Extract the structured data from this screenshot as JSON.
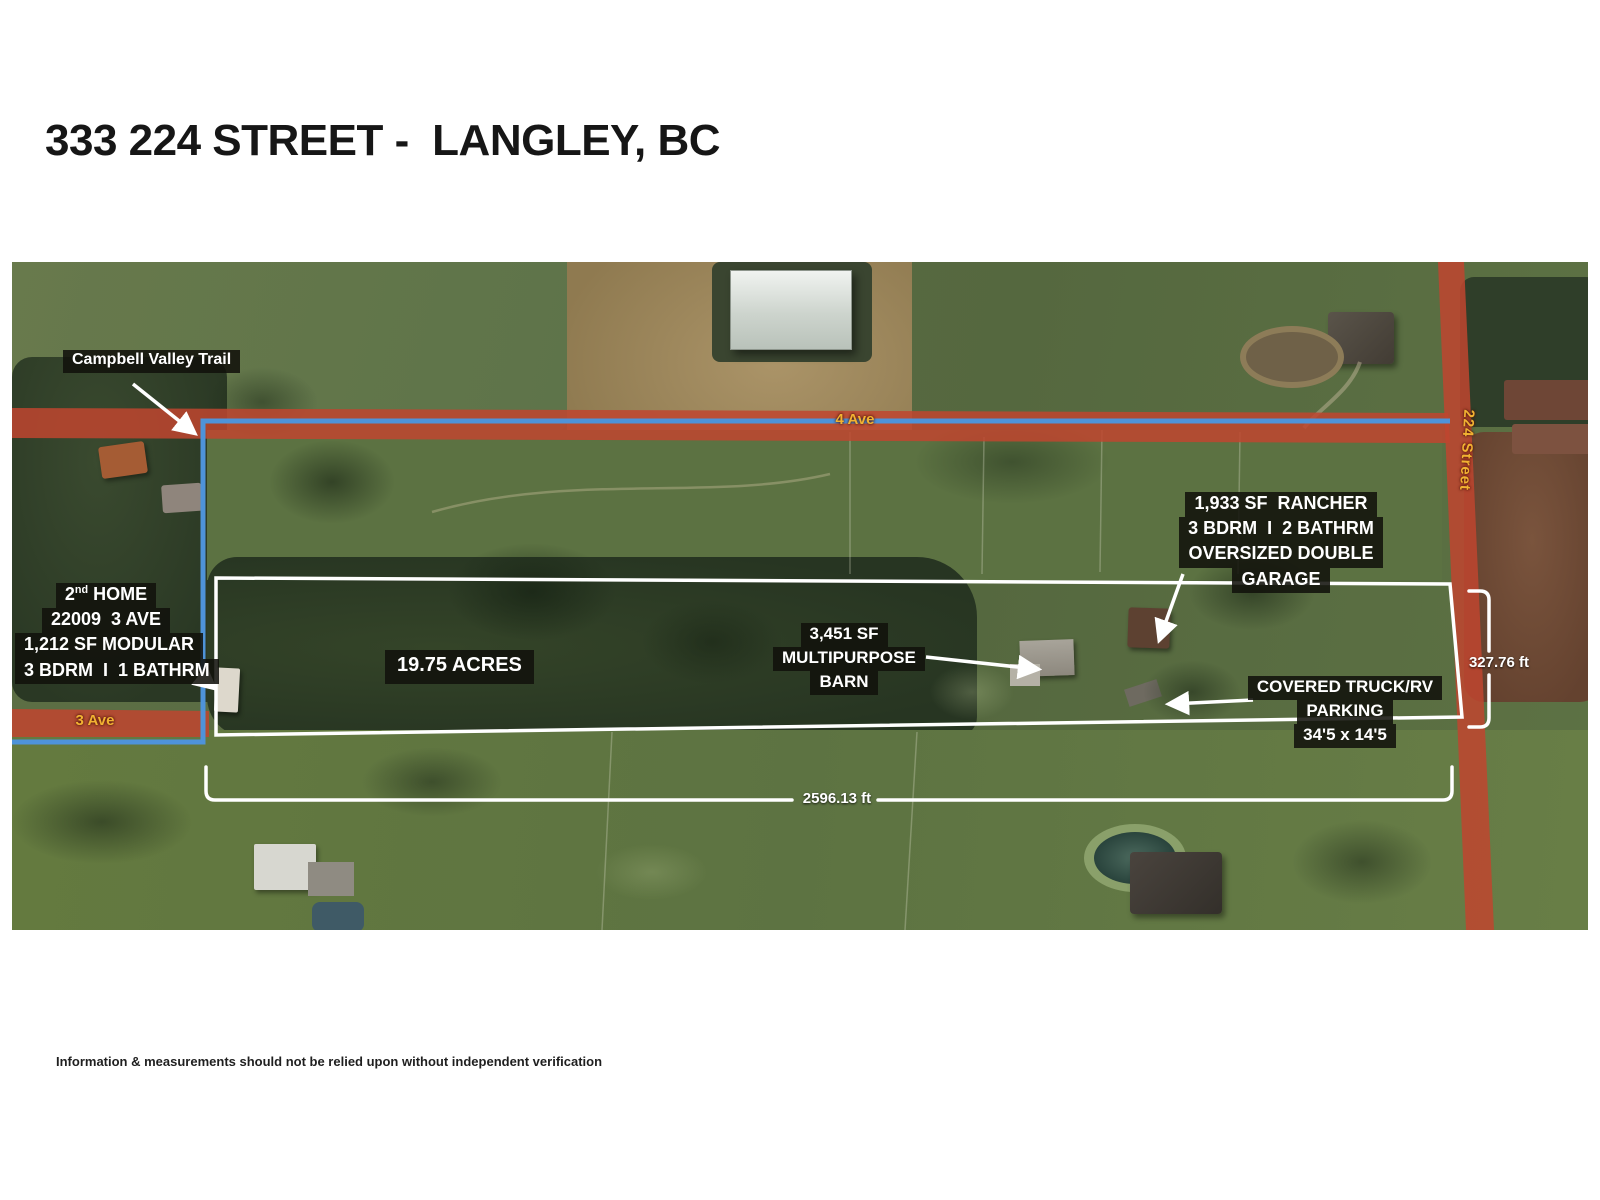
{
  "page": {
    "title": "333 224 STREET -  LANGLEY, BC",
    "disclaimer": "Information & measurements should not be relied upon without independent verification"
  },
  "map": {
    "trail_label": "Campbell Valley Trail",
    "streets": {
      "ave4": "4 Ave",
      "ave3": "3 Ave",
      "street224": "224 Street"
    },
    "acreage": "19.75 ACRES",
    "rancher": {
      "line1": "1,933 SF  RANCHER",
      "line2": "3 BDRM  I  2 BATHRM",
      "line3": "OVERSIZED DOUBLE",
      "line4": "GARAGE"
    },
    "second_home": {
      "line1_num": "2",
      "line1_sup": "nd",
      "line1_rest": " HOME",
      "line2": "22009  3 AVE",
      "line3": "1,212 SF MODULAR",
      "line4": "3 BDRM  I  1 BATHRM"
    },
    "barn": {
      "line1": "3,451 SF",
      "line2": "MULTIPURPOSE",
      "line3": "BARN"
    },
    "parking": {
      "line1": "COVERED TRUCK/RV",
      "line2": "PARKING",
      "line3": "34'5 x 14'5"
    },
    "measurements": {
      "east_depth": "327.76 ft",
      "south_frontage": "2596.13 ft"
    },
    "colors": {
      "road_overlay_red": "#c0452f",
      "trail_blue": "#4e93d9",
      "boundary_white": "#ffffff",
      "street_label_yellow": "#f2b232",
      "label_bg_dark": "rgba(17,17,12,0.87)"
    }
  }
}
